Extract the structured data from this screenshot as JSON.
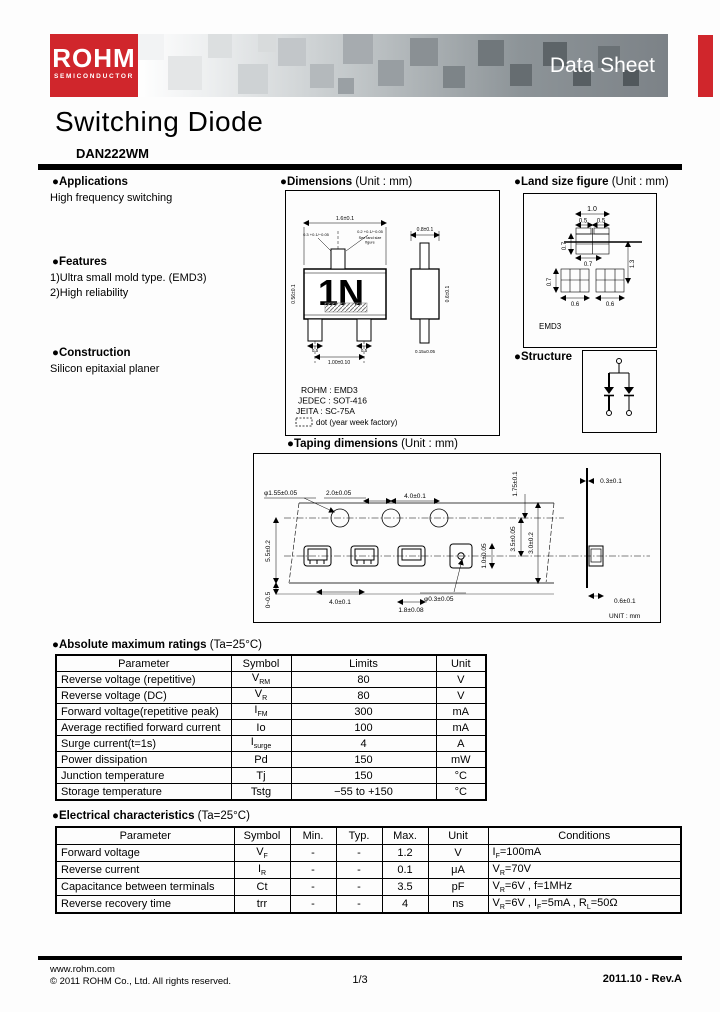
{
  "header": {
    "logo_title": "ROHM",
    "logo_subtitle": "SEMICONDUCTOR",
    "banner_title": "Data Sheet",
    "accent_color": "#d0262c"
  },
  "title": {
    "main": "Switching Diode",
    "part": "DAN222WM"
  },
  "sections": {
    "applications": {
      "heading": "●Applications",
      "body": "High frequency switching"
    },
    "features": {
      "heading": "●Features",
      "items": [
        "1)Ultra small mold type. (EMD3)",
        "2)High reliability"
      ]
    },
    "construction": {
      "heading": "●Construction",
      "body": "Silicon epitaxial planer"
    },
    "dimensions": {
      "heading": "●Dimensions",
      "unit": " (Unit : mm)",
      "marking": "1N",
      "standards": [
        "ROHM : EMD3",
        "JEDEC : SOT-416",
        "JEITA : SC-75A"
      ],
      "dot_note": "dot (year week factory)",
      "labels": {
        "top_width": "1.6±0.1",
        "lead_left": "0.3 +0.1/−0.05",
        "lead_right": "0.2 +0.1/−0.05",
        "note_line1": "See land size",
        "note_line2": "figure",
        "left_height": "0.56±0.1",
        "bottom_left": "0.5",
        "bottom_right": "0.5",
        "bottom_pitch": "1.00±0.10",
        "side_top": "0.8±0.1",
        "side_right": "0.6±0.1",
        "side_bottom": "0.15±0.05"
      }
    },
    "land": {
      "heading": "●Land size figure",
      "unit": " (Unit : mm)",
      "package": "EMD3",
      "labels": {
        "top": "1.0",
        "top_left": "0.5",
        "top_right": "0.5",
        "upper_left": "0.7",
        "mid": "0.7",
        "right": "1.3",
        "lower_left": "0.7",
        "bottom_left": "0.6",
        "bottom_right": "0.6"
      }
    },
    "structure": {
      "heading": "●Structure"
    },
    "taping": {
      "heading": "●Taping dimensions",
      "unit": " (Unit : mm)",
      "labels": {
        "hole_dia": "φ1.55±0.05",
        "pitch_half": "2.0±0.05",
        "pitch": "4.0±0.1",
        "edge": "1.75±0.1",
        "thickness": "0.3±0.1",
        "hole_to_pocket": "3.5±0.05",
        "width_dim": "3.0±0.2",
        "pocket_width": "1.0±0.05",
        "tape_left": "5.5±0.2",
        "gap": "0~0.5",
        "pocket_pitch": "4.0±0.1",
        "pocket_length": "1.8±0.08",
        "pocket_hole": "φ0.3±0.05",
        "side_width": "0.6±0.1",
        "unit_note": "UNIT : mm"
      }
    }
  },
  "abs_max": {
    "heading": "●Absolute maximum ratings",
    "condition": " (Ta=25°C)",
    "columns": [
      "Parameter",
      "Symbol",
      "Limits",
      "Unit"
    ],
    "rows": [
      {
        "parameter": "Reverse voltage (repetitive)",
        "symbol": [
          [
            "V",
            0
          ],
          [
            "RM",
            1
          ]
        ],
        "limits": "80",
        "unit": "V"
      },
      {
        "parameter": "Reverse voltage (DC)",
        "symbol": [
          [
            "V",
            0
          ],
          [
            "R",
            1
          ]
        ],
        "limits": "80",
        "unit": "V"
      },
      {
        "parameter": "Forward voltage(repetitive peak)",
        "symbol": [
          [
            "I",
            0
          ],
          [
            "FM",
            1
          ]
        ],
        "limits": "300",
        "unit": "mA"
      },
      {
        "parameter": "Average rectified forward current",
        "symbol": [
          [
            "Io",
            0
          ]
        ],
        "limits": "100",
        "unit": "mA"
      },
      {
        "parameter": "Surge current(t=1s)",
        "symbol": [
          [
            "I",
            0
          ],
          [
            "surge",
            1
          ]
        ],
        "limits": "4",
        "unit": "A"
      },
      {
        "parameter": "Power dissipation",
        "symbol": [
          [
            "Pd",
            0
          ]
        ],
        "limits": "150",
        "unit": "mW"
      },
      {
        "parameter": "Junction temperature",
        "symbol": [
          [
            "Tj",
            0
          ]
        ],
        "limits": "150",
        "unit": "°C"
      },
      {
        "parameter": "Storage temperature",
        "symbol": [
          [
            "Tstg",
            0
          ]
        ],
        "limits": "−55 to +150",
        "unit": "°C"
      }
    ]
  },
  "elec": {
    "heading": "●Electrical characteristics",
    "condition": " (Ta=25°C)",
    "columns": [
      "Parameter",
      "Symbol",
      "Min.",
      "Typ.",
      "Max.",
      "Unit",
      "Conditions"
    ],
    "rows": [
      {
        "parameter": "Forward voltage",
        "symbol": [
          [
            "V",
            0
          ],
          [
            "F",
            1
          ]
        ],
        "min": "-",
        "typ": "-",
        "max": "1.2",
        "unit": "V",
        "conditions": [
          [
            "I",
            0
          ],
          [
            "F",
            1
          ],
          [
            "=100mA",
            0
          ]
        ]
      },
      {
        "parameter": "Reverse current",
        "symbol": [
          [
            "I",
            0
          ],
          [
            "R",
            1
          ]
        ],
        "min": "-",
        "typ": "-",
        "max": "0.1",
        "unit": "μA",
        "conditions": [
          [
            "V",
            0
          ],
          [
            "R",
            1
          ],
          [
            "=70V",
            0
          ]
        ]
      },
      {
        "parameter": "Capacitance between terminals",
        "symbol": [
          [
            "Ct",
            0
          ]
        ],
        "min": "-",
        "typ": "-",
        "max": "3.5",
        "unit": "pF",
        "conditions": [
          [
            "V",
            0
          ],
          [
            "R",
            1
          ],
          [
            "=6V , f=1MHz",
            0
          ]
        ]
      },
      {
        "parameter": "Reverse recovery time",
        "symbol": [
          [
            "trr",
            0
          ]
        ],
        "min": "-",
        "typ": "-",
        "max": "4",
        "unit": "ns",
        "conditions": [
          [
            "V",
            0
          ],
          [
            "R",
            1
          ],
          [
            "=6V , I",
            0
          ],
          [
            "F",
            1
          ],
          [
            "=5mA , R",
            0
          ],
          [
            "L",
            1
          ],
          [
            "=50Ω",
            0
          ]
        ]
      }
    ]
  },
  "footer": {
    "url": "www.rohm.com",
    "copyright": "© 2011  ROHM Co., Ltd. All rights reserved.",
    "page": "1/3",
    "revision": "2011.10 - Rev.A"
  }
}
